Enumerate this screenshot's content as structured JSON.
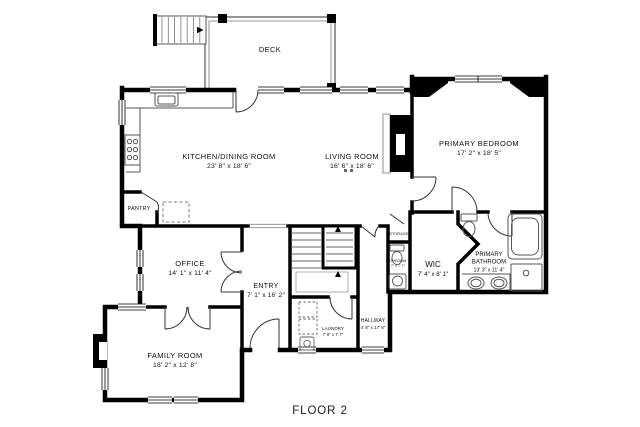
{
  "floor_label": "FLOOR 2",
  "rooms": {
    "deck": {
      "name": "DECK"
    },
    "kitchen_dining": {
      "name": "KITCHEN/DINING ROOM",
      "dims": "23' 8\" x 18' 6\""
    },
    "living_room": {
      "name": "LIVING ROOM",
      "dims": "16' 6\" x 18' 6\""
    },
    "primary_bedroom": {
      "name": "PRIMARY BEDROOM",
      "dims": "17' 2\" x 18' 5\""
    },
    "pantry": {
      "name": "PANTRY"
    },
    "office": {
      "name": "OFFICE",
      "dims": "14' 1\" x 11' 4\""
    },
    "entry": {
      "name": "ENTRY",
      "dims": "7' 1\" x 16' 2\""
    },
    "family_room": {
      "name": "FAMILY ROOM",
      "dims": "18' 2\" x 12' 8\""
    },
    "laundry": {
      "name": "LAUNDRY",
      "dims": "7' 8\" x 7' 7\""
    },
    "hallway": {
      "name": "HALLWAY",
      "dims": "4' 8\" x 17' 8\""
    },
    "storage": {
      "name": "STORAGE"
    },
    "bathroom": {
      "name": "BATHROOM",
      "dims": "3' 7\" x 7' 7\""
    },
    "wic": {
      "name": "WIC",
      "dims": "7' 4\" x 8' 1\""
    },
    "primary_bathroom": {
      "name_line1": "PRIMARY",
      "name_line2": "BATHROOM",
      "dims": "13' 3\" x 11' 4\""
    }
  },
  "colors": {
    "wall": "#000000",
    "fixture_line": "#555555",
    "background": "#ffffff"
  }
}
